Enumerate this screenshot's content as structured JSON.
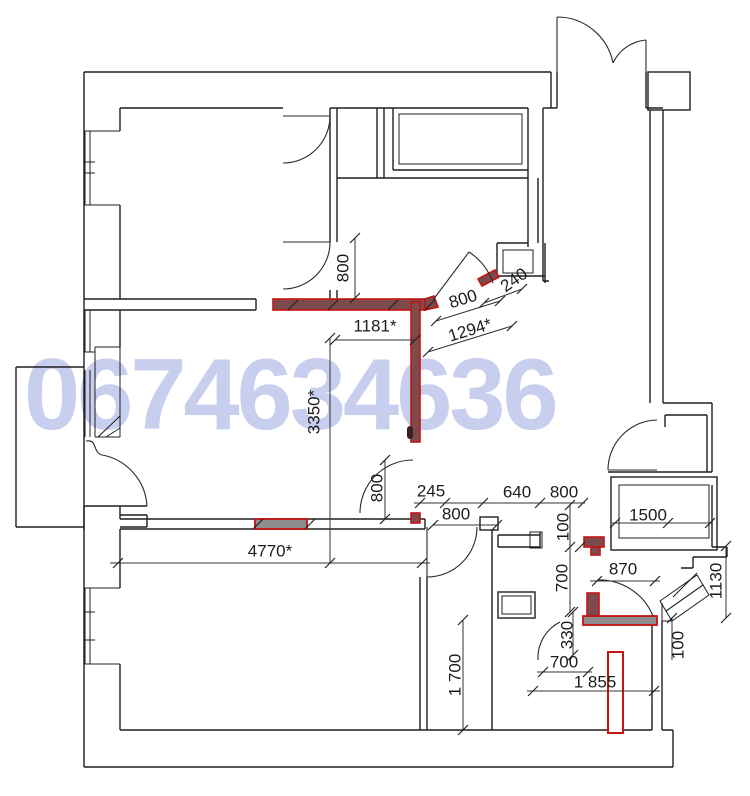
{
  "watermark": {
    "text": "0674634636"
  },
  "colors": {
    "wall": "#1f1f1f",
    "dim": "#1c1c1c",
    "red_wall_border": "#c41414",
    "red_wall_fill": "#7d4b4b",
    "red_wall_gray_fill": "#8d8d8d",
    "watermark": "#c3c9ec",
    "background": "#ffffff"
  },
  "dims": {
    "v800_top": "800",
    "w1181": "1181*",
    "d800_diag": "800",
    "w1294": "1294*",
    "w240": "240",
    "v3350": "3350*",
    "v800_door": "800",
    "w245": "245",
    "w800_hall": "800",
    "w640": "640",
    "w800_row": "800",
    "v100_top": "100",
    "w1500": "1500",
    "v700": "700",
    "w870": "870",
    "v1130": "1130",
    "v100_low": "100",
    "v330": "330",
    "w700_low": "700",
    "w1855": "1 855",
    "v1700": "1 700",
    "w4770": "4770*"
  }
}
